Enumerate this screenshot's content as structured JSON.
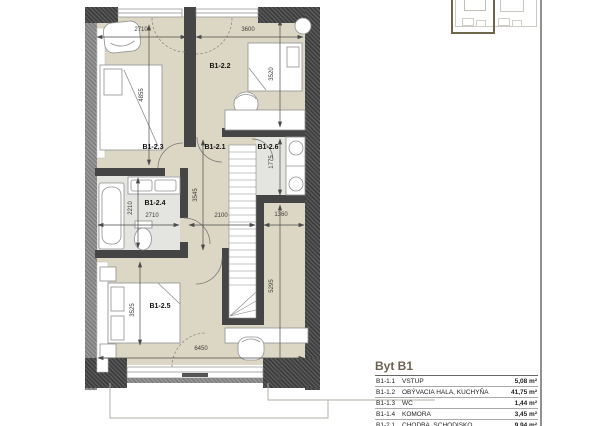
{
  "rooms": [
    {
      "label": "B1-2.2"
    },
    {
      "label": "B1-2.3"
    },
    {
      "label": "B1-2.1"
    },
    {
      "label": "B1-2.6"
    },
    {
      "label": "B1-2.4"
    },
    {
      "label": "B1-2.5"
    }
  ],
  "dims": {
    "bedroom3_width": "2710",
    "bedroom2_width": "3600",
    "bedroom3_height": "4855",
    "bedroom2_height": "3520",
    "wc_height": "1775",
    "hall_height": "3545",
    "bath_width": "2710",
    "bath_height": "2210",
    "hall_width": "2100",
    "niche_width": "1360",
    "right_height": "5295",
    "bedroom5_height": "3525",
    "unit_width": "6450"
  },
  "legend": {
    "title": "Byt B1",
    "rows": [
      {
        "code": "B1-1.1",
        "name": "VSTUP",
        "area": "5,08 m²"
      },
      {
        "code": "B1-1.2",
        "name": "OBÝVACIA HALA, KUCHYŇA",
        "area": "41,75 m²"
      },
      {
        "code": "B1-1.3",
        "name": "WC",
        "area": "1,44 m²"
      },
      {
        "code": "B1-1.4",
        "name": "KOMORA",
        "area": "3,45 m²"
      },
      {
        "code": "B1-2.1",
        "name": "CHODBA, SCHODISKO",
        "area": "9,94 m²"
      }
    ]
  },
  "colors": {
    "floor": "#dcd7c4",
    "bath_floor": "#e4e4e1",
    "wall": "#454545",
    "accent": "#6f654a"
  }
}
